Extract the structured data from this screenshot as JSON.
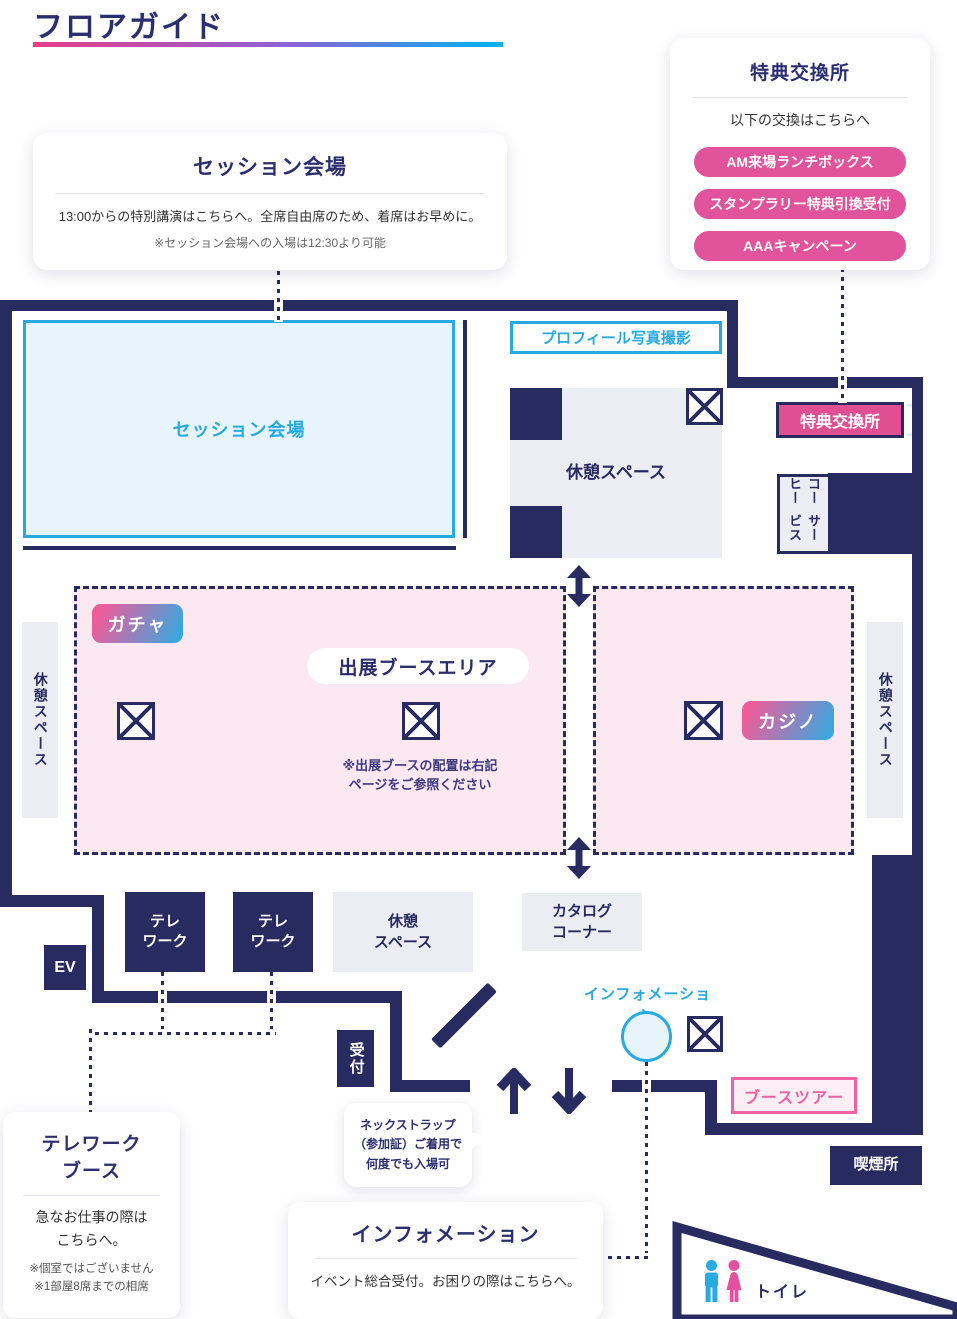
{
  "page": {
    "title": "フロアガイド"
  },
  "colors": {
    "navy": "#272b60",
    "pink": "#e1539b",
    "badge_pink": "#e04f92",
    "accent_pink": "#ee62a2",
    "cyan": "#27aae1",
    "light_blue": "#e8f4fc",
    "light_gray": "#ececf3",
    "light_pink": "#fbe8f1",
    "gradient_pill": "pink-to-blue",
    "title_underline": "pink-to-cyan"
  },
  "session_card": {
    "title": "セッション会場",
    "body": "13:00からの特別講演はこちらへ。全席自由席のため、着席はお早めに。",
    "note": "※セッション会場への入場は12:30より可能"
  },
  "benefit_card": {
    "title": "特典交換所",
    "subtitle": "以下の交換はこちらへ",
    "buttons": [
      "AM来場ランチボックス",
      "スタンプラリー特典引換受付",
      "AAAキャンペーン"
    ]
  },
  "telework_card": {
    "title_lines": [
      "テレワーク",
      "ブース"
    ],
    "body_lines": [
      "急なお仕事の際は",
      "こちらへ。"
    ],
    "notes": [
      "※個室ではございません",
      "※1部屋8席までの相席"
    ]
  },
  "info_card": {
    "title": "インフォメーション",
    "body": "イベント総合受付。お困りの際はこちらへ。"
  },
  "strap_bubble": {
    "lines": [
      "ネックストラップ",
      "（参加証）ご着用で",
      "何度でも入場可"
    ]
  },
  "map": {
    "session_room": "セッション会場",
    "profile_photo": "プロフィール写真撮影",
    "rest_space": "休憩スペース",
    "rest_space_lines": [
      "休憩",
      "スペース"
    ],
    "benefit_booth": "特典交換所",
    "coffee_lines": [
      "コーヒー",
      "サービス"
    ],
    "gacha": "ガチャ",
    "booth_area": "出展ブースエリア",
    "booth_note_lines": [
      "※出展ブースの配置は右記",
      "ページをご参照ください"
    ],
    "casino": "カジノ",
    "ev": "EV",
    "telework_lines": [
      "テレ",
      "ワーク"
    ],
    "catalog_lines": [
      "カタログ",
      "コーナー"
    ],
    "reception": "受付",
    "information": "インフォメーション",
    "booth_tour": "ブースツアー",
    "smoking": "喫煙所",
    "toilet": "トイレ"
  },
  "icons": {
    "crossed_box": "boxed-x",
    "up_arrow": "↑",
    "down_arrow": "↓",
    "double_arrow": "↕",
    "door_swing": "diagonal-line",
    "man_pictogram": "restroom-man",
    "woman_pictogram": "restroom-woman"
  }
}
